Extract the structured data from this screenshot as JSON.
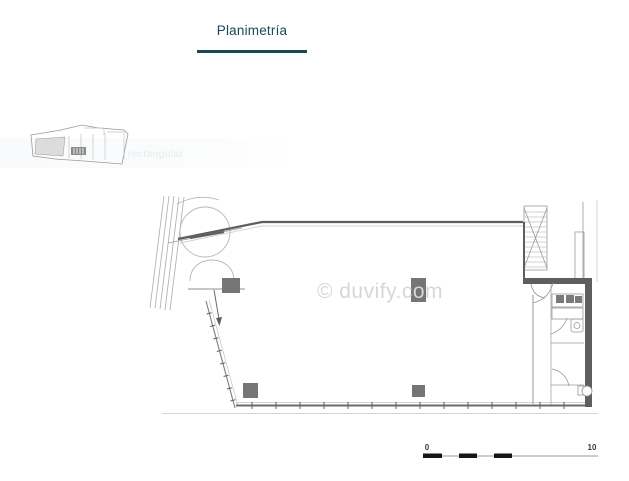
{
  "tabs": [
    {
      "label": "Planimetría",
      "active": true
    }
  ],
  "gallery": {
    "thumbnail_watermark": "rectangular"
  },
  "plan": {
    "watermark": "© duvify.com",
    "scale_bar": {
      "start_label": "0",
      "end_label": "10"
    }
  },
  "colors": {
    "accent": "#1c4758",
    "wall_dark": "#5e5e5e",
    "column_fill": "#757575",
    "watermark_gray": "#d7d7d7",
    "scale_black": "#161616"
  }
}
